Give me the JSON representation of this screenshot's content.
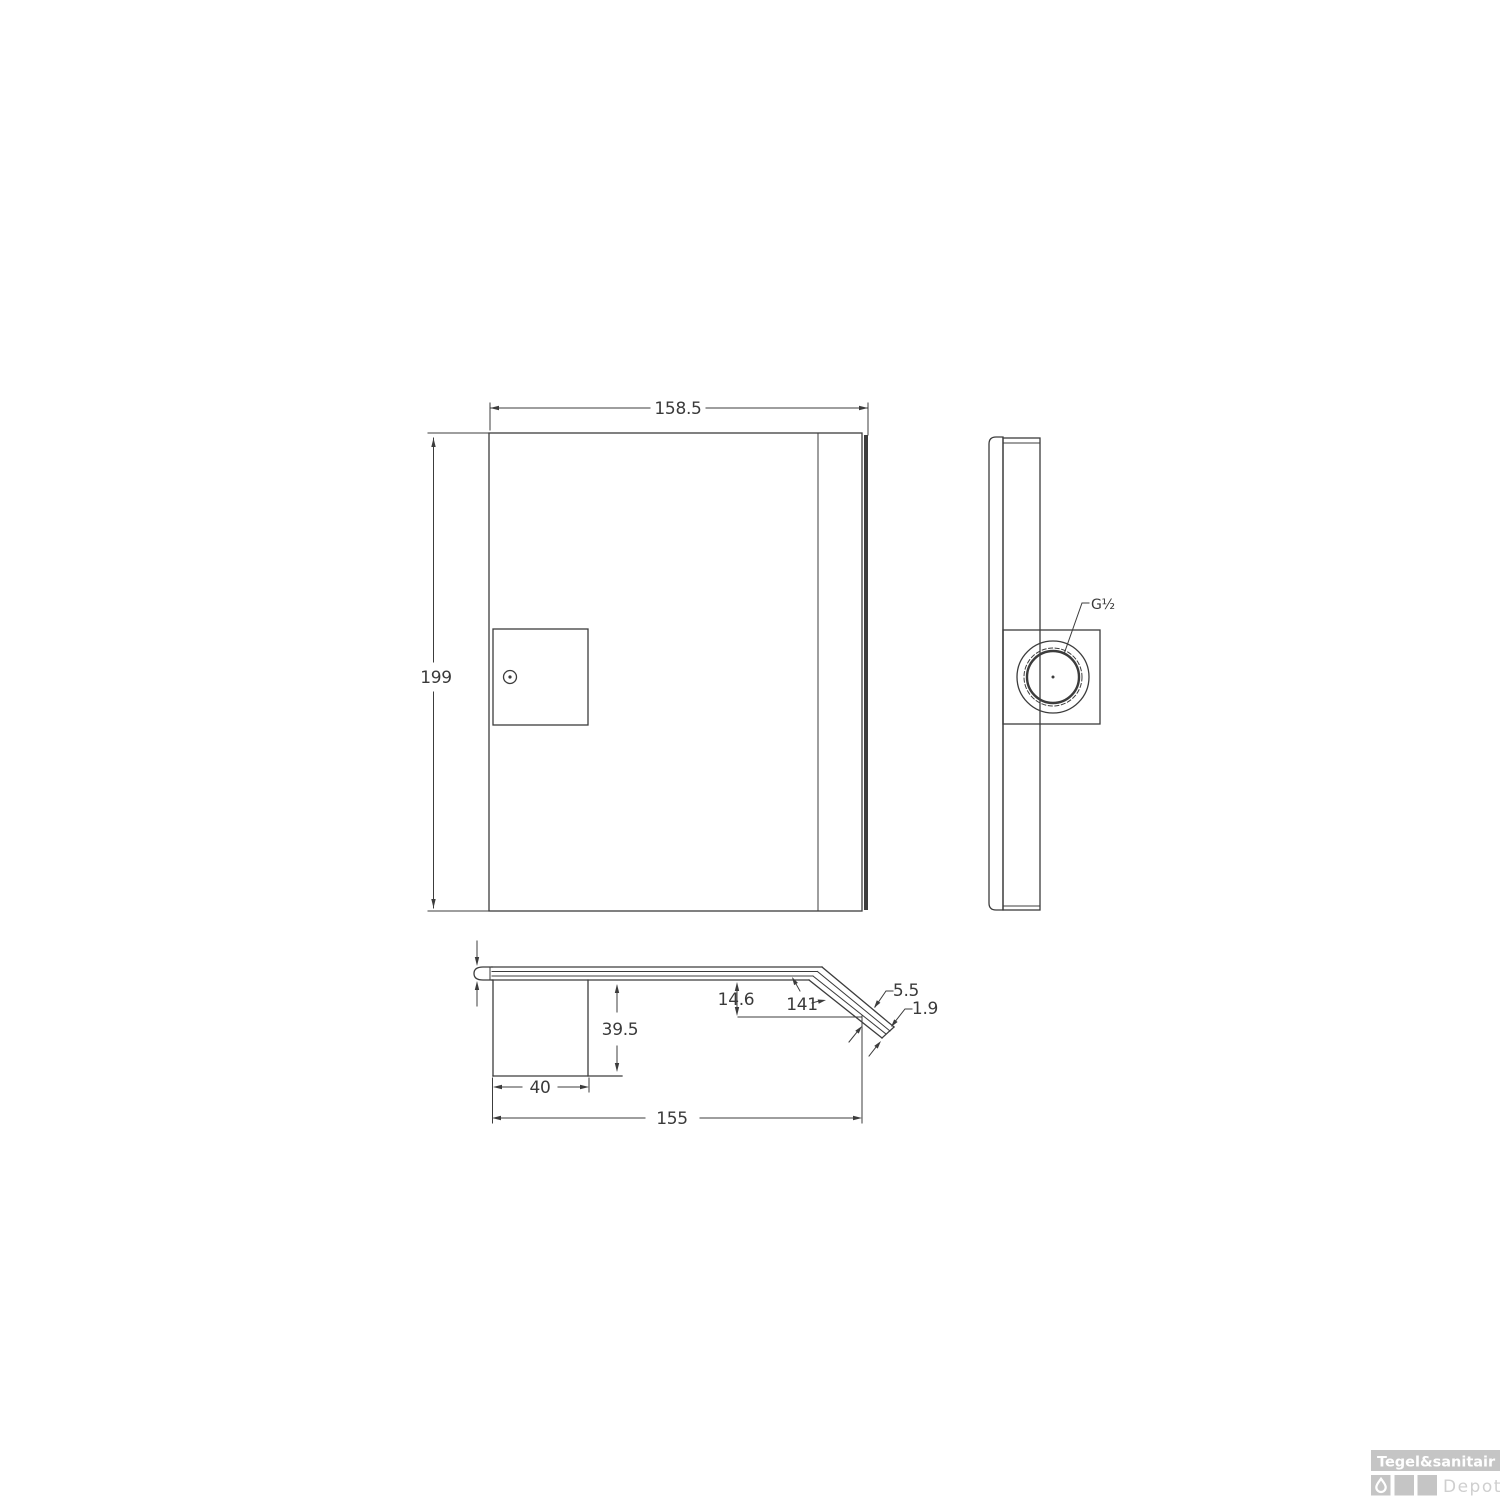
{
  "drawing": {
    "type": "technical-drawing-3-views",
    "line_color": "#3c3c3c",
    "text_color": "#3a3a3a",
    "front_view": {
      "width_dim": "158.5",
      "height_dim": "199"
    },
    "side_view": {
      "thread_dim": "G½"
    },
    "top_view": {
      "drop_dim": "14.6",
      "angle_dim": "141",
      "thickness_dim": "5.5",
      "glass_dim": "1.9",
      "inlet_depth_dim": "39.5",
      "inlet_width_dim": "40",
      "total_depth_dim": "155"
    }
  },
  "logo": {
    "brand": "Tegel&sanitair",
    "sub_brand": "Depot",
    "bar_color": "#c5c5c5",
    "square_color": "#c5c5c5",
    "text_color": "#ffffff",
    "sub_color": "#cfcfcf"
  }
}
